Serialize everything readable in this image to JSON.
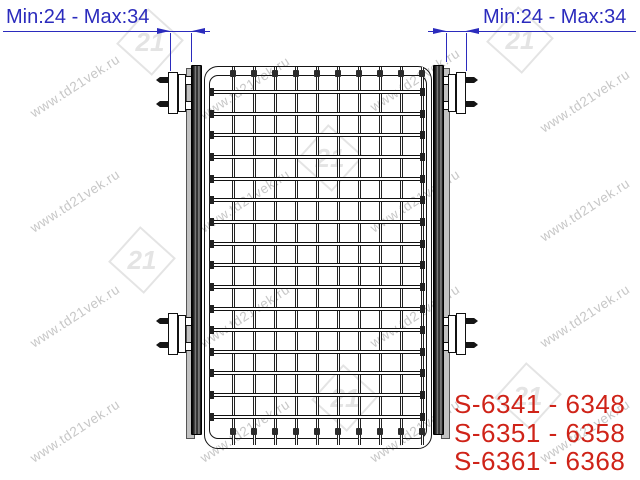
{
  "page": {
    "background": "#ffffff"
  },
  "dimensions": {
    "color": "#2b2bbd",
    "left": {
      "label": "Min:24 - Max:34"
    },
    "right": {
      "label": "Min:24 - Max:34"
    }
  },
  "product_codes": {
    "color": "#cf2318",
    "lines": [
      "S-6341 - 6348",
      "S-6351 - 6358",
      "S-6361 - 6368"
    ]
  },
  "drawing": {
    "description": "Front view of a wire mesh pull-out basket with two side mounting rails and four fixing brackets with screws",
    "line_color": "#151515",
    "mesh": {
      "vertical_wires": 10,
      "horizontal_wires": 16
    }
  },
  "watermark": {
    "text": "www.td21vek.ru",
    "logo_text": "21",
    "text_color": "#c7c7c7",
    "logo_color": "#e4e4e4",
    "text_positions": [
      [
        75,
        86
      ],
      [
        245,
        88
      ],
      [
        415,
        80
      ],
      [
        585,
        101
      ],
      [
        75,
        201
      ],
      [
        245,
        201
      ],
      [
        415,
        201
      ],
      [
        585,
        210
      ],
      [
        75,
        316
      ],
      [
        245,
        316
      ],
      [
        415,
        316
      ],
      [
        585,
        316
      ],
      [
        75,
        431
      ],
      [
        245,
        431
      ],
      [
        415,
        431
      ],
      [
        585,
        431
      ]
    ],
    "logo_positions": [
      [
        150,
        42
      ],
      [
        520,
        40
      ],
      [
        330,
        158
      ],
      [
        142,
        260
      ],
      [
        345,
        398
      ],
      [
        528,
        396
      ]
    ]
  }
}
